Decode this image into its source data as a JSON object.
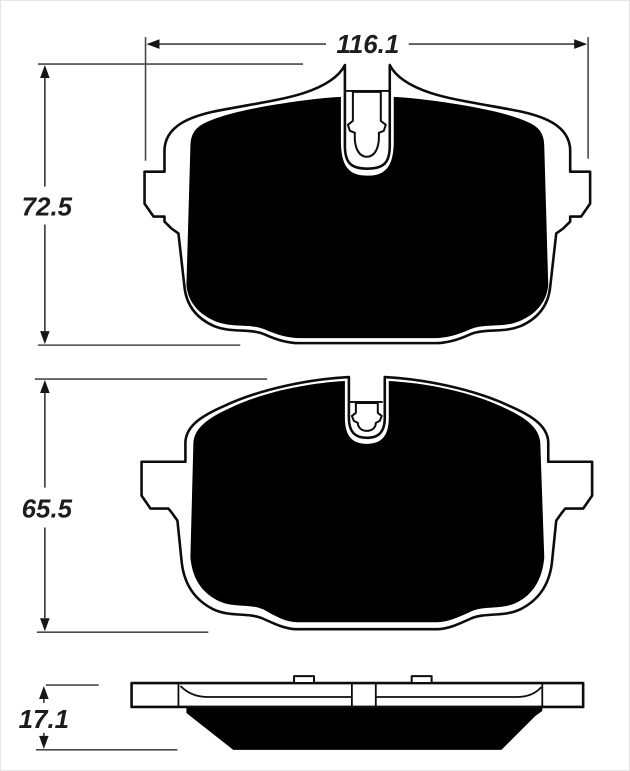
{
  "drawing": {
    "type": "brake-pad-dimension-drawing",
    "dimensions": {
      "outer_pad_width": "116.1",
      "outer_pad_height": "72.5",
      "inner_pad_height": "65.5",
      "pad_thickness": "17.1"
    },
    "colors": {
      "part_outline": "#0c0c0c",
      "friction_fill": "#000000",
      "dimension_line": "#434343",
      "label_text": "#1d1d1d",
      "background": "#ffffff"
    }
  }
}
